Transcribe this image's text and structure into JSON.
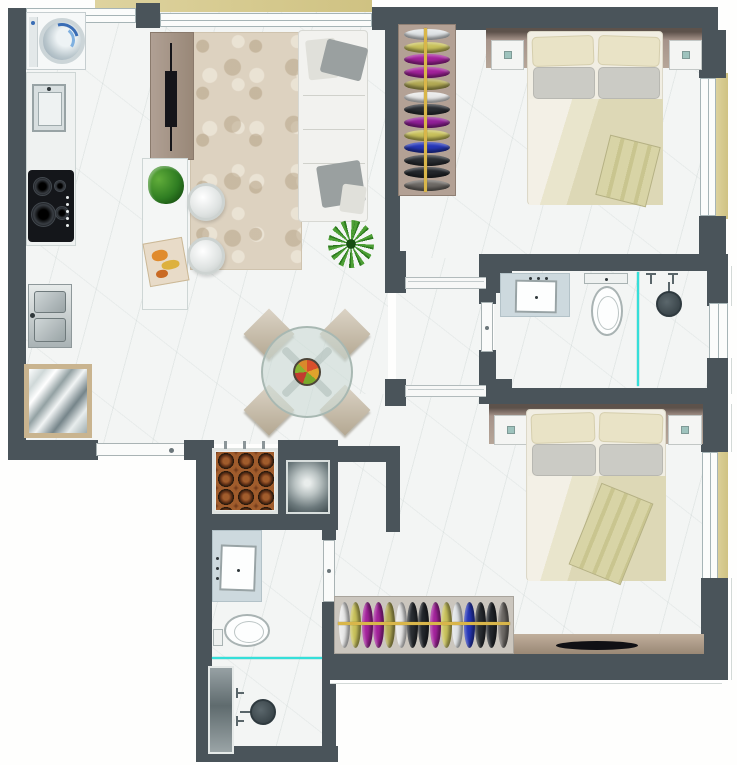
{
  "floorplan": {
    "title": "2-bedroom apartment floor plan",
    "colors": {
      "wall": "#4a545a",
      "floor_marble": "#f3f5f4",
      "rug": "#ddd2c0",
      "wood": "#a5938a",
      "balcony_strip": "#d8cc90",
      "glass_partition": "#35dfd9",
      "closet_rod": "#d9b64a",
      "linen_cream": "#e9e3c6",
      "linen_gray": "#cbcbc5",
      "blanket_khaki": "#d6d2a4"
    },
    "rooms": {
      "kitchen": "kitchen",
      "living_dining": "living-dining room",
      "bedroom1": "bedroom 1 (top right)",
      "bathroom1": "bathroom 1 (en-suite, right)",
      "bedroom2": "bedroom 2 (bottom right)",
      "bathroom2": "bathroom 2 (bottom left)",
      "hall": "hall",
      "grill_niche": "barbecue niche"
    },
    "furniture": {
      "washer": "washing machine",
      "kitchen_sink": "kitchen sink",
      "cooktop": "cooktop with burners",
      "double_sink": "double basin sink",
      "mirror_table": "mirror-top table",
      "tv_panel": "tv panel",
      "sofa": "sofa with cushions",
      "rug": "living room rug",
      "plant": "potted plant",
      "bar_counter": "bar counter",
      "stool": "bar stool",
      "dining_table": "round glass dining table",
      "chair": "dining chair",
      "fruit_bowl": "fruit bowl",
      "grill": "barbecue grill with skewers",
      "side_table": "metal side table",
      "bed": "double bed with pillows and blanket",
      "nightstand": "nightstand",
      "wardrobe": "wardrobe with hanging clothes",
      "vanity": "bathroom vanity sink",
      "toilet": "toilet",
      "shower": "shower head with handles",
      "shower_niche": "shower niche panel",
      "tv_rack": "tv rack",
      "tv": "television",
      "entry_door": "entry door",
      "sliding_door": "sliding door",
      "door": "door",
      "window": "window",
      "glass_divider": "glass shower divider"
    },
    "wardrobe1_clothes": [
      "#dfe3e6",
      "#c9c25c",
      "#a4239c",
      "#a4239c",
      "#b3ab55",
      "#e8e8e8",
      "#2a2e33",
      "#93209a",
      "#c9c25c",
      "#2637b8",
      "#2a2e33",
      "#23272c",
      "#6e6a66"
    ],
    "wardrobe2_clothes": [
      "#e8e8e8",
      "#c9c25c",
      "#a4239c",
      "#a4239c",
      "#b3ab55",
      "#e8e8e8",
      "#2a2e33",
      "#23272c",
      "#a4239c",
      "#c9c25c",
      "#dfe3e6",
      "#2637b8",
      "#2a2e33",
      "#23272c",
      "#6e6a66"
    ]
  }
}
